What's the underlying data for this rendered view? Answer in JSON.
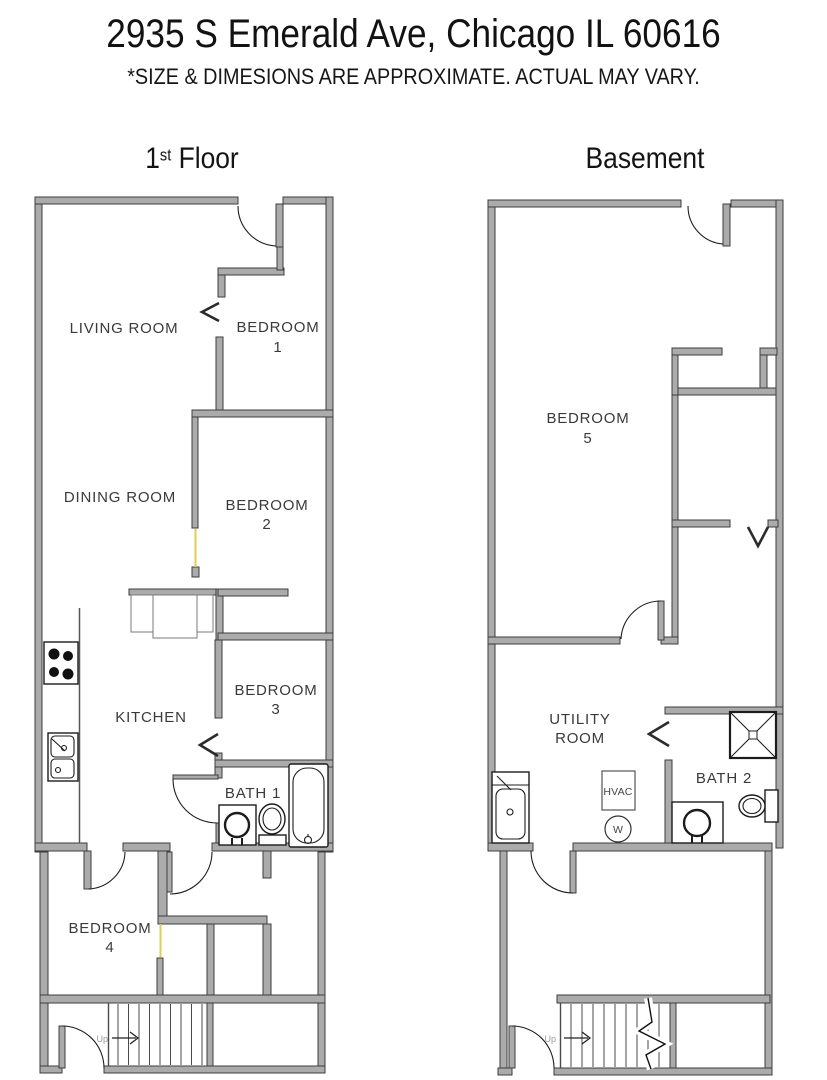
{
  "header": {
    "title": "2935 S Emerald Ave, Chicago IL 60616",
    "disclaimer": "*SIZE & DIMESIONS ARE APPROXIMATE. ACTUAL MAY VARY."
  },
  "plans": {
    "first_floor": {
      "label_number": "1",
      "label_ordinal": "st",
      "label_name": "Floor",
      "rooms": {
        "living_room": "LIVING ROOM",
        "bedroom1_line1": "BEDROOM",
        "bedroom1_line2": "1",
        "dining_room": "DINING ROOM",
        "bedroom2_line1": "BEDROOM",
        "bedroom2_line2": "2",
        "kitchen": "KITCHEN",
        "bedroom3_line1": "BEDROOM",
        "bedroom3_line2": "3",
        "bath1": "BATH 1",
        "bedroom4_line1": "BEDROOM",
        "bedroom4_line2": "4",
        "stairs_up": "Up"
      }
    },
    "basement": {
      "label": "Basement",
      "rooms": {
        "bedroom5_line1": "BEDROOM",
        "bedroom5_line2": "5",
        "utility_line1": "UTILITY",
        "utility_line2": "ROOM",
        "bath2": "BATH 2",
        "hvac": "HVAC",
        "washer": "W",
        "stairs_up": "Up"
      }
    }
  },
  "colors": {
    "wall_fill": "#ababab",
    "wall_stroke": "#3c3c3c",
    "door_leaf_accent": "#dfce54",
    "label_text": "#3a3a3a"
  }
}
